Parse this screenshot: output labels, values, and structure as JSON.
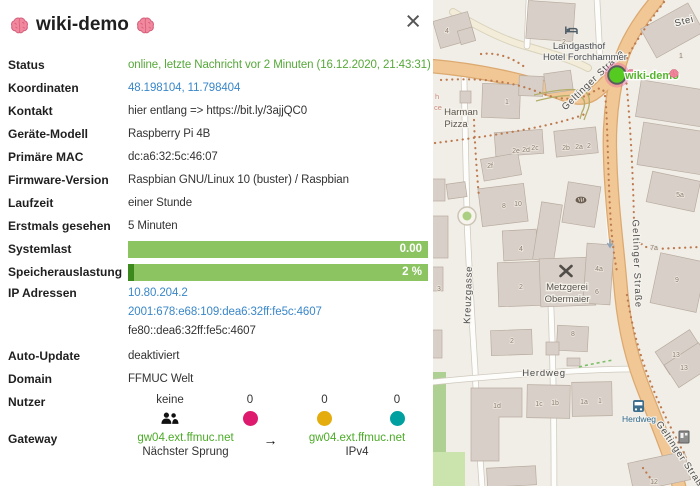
{
  "panel": {
    "title": "wiki-demo",
    "close": "×",
    "rows": {
      "status": {
        "label": "Status",
        "value": "online, letzte Nachricht vor 2 Minuten (16.12.2020, 21:43:31)"
      },
      "koordinaten": {
        "label": "Koordinaten",
        "value": "48.198104, 11.798404"
      },
      "kontakt": {
        "label": "Kontakt",
        "value": "hier entlang => https://bit.ly/3ajjQC0"
      },
      "geraet": {
        "label": "Geräte-Modell",
        "value": "Raspberry Pi 4B"
      },
      "mac": {
        "label": "Primäre MAC",
        "value": "dc:a6:32:5c:46:07"
      },
      "firmware": {
        "label": "Firmware-Version",
        "value": "Raspbian GNU/Linux 10 (buster) / Raspbian"
      },
      "laufzeit": {
        "label": "Laufzeit",
        "value": "einer Stunde"
      },
      "erstmals": {
        "label": "Erstmals gesehen",
        "value": "5 Minuten"
      },
      "systemlast": {
        "label": "Systemlast",
        "value": "0.00",
        "percent": 0
      },
      "speicher": {
        "label": "Speicherauslastung",
        "value": "2 %",
        "percent": 2
      },
      "ip": {
        "label": "IP Adressen",
        "addresses": [
          "10.80.204.2",
          "2001:678:e68:109:dea6:32ff:fe5c:4607",
          "fe80::dea6:32ff:fe5c:4607"
        ]
      },
      "autoupdate": {
        "label": "Auto-Update",
        "value": "deaktiviert"
      },
      "domain": {
        "label": "Domain",
        "value": "FFMUC Welt"
      },
      "nutzer": {
        "label": "Nutzer",
        "clients_total": "keine",
        "counts": [
          "0",
          "0",
          "0"
        ]
      },
      "gateway": {
        "label": "Gateway",
        "next_hop": "gw04.ext.ffmuc.net",
        "arrow": "→",
        "next_hop_caption": "Nächster Sprung",
        "ipv4_gw": "gw04.ext.ffmuc.net",
        "ipv4_caption": "IPv4"
      }
    }
  },
  "map": {
    "node_label": "wiki-demo",
    "streets": {
      "geltinger": "Geltinger Straße",
      "kreuzgasse": "Kreuzgasse",
      "herdweg": "Herdweg",
      "stein": "Stei"
    },
    "pois": {
      "hotel1": "Landgasthof",
      "hotel2": "Hotel Forchhammer",
      "pizza1": "Harman",
      "pizza2": "Pizza",
      "metzgerei1": "Metzgerei",
      "metzgerei2": "Obermaier",
      "bus_stop": "Herdweg"
    },
    "housenumbers": [
      "4",
      "2",
      "1",
      "1",
      "2e",
      "2d",
      "2c",
      "2b",
      "2a",
      "2",
      "2f",
      "8",
      "10",
      "4",
      "2",
      "5a",
      "7a",
      "9",
      "4a",
      "6",
      "3",
      "2",
      "8",
      "13",
      "13",
      "1d",
      "1c",
      "1b",
      "1a",
      "1",
      "12"
    ],
    "fragments": [
      "h",
      "ce"
    ]
  },
  "colors": {
    "online_green": "#56a83a",
    "link_blue": "#3a87c8",
    "gateway_green": "#4cab28",
    "bar_green_light": "#8cc462",
    "bar_green_dark": "#3c8a1e",
    "client_dot_pink": "#dd1a6e",
    "client_dot_yellow": "#e5ac0e",
    "client_dot_teal": "#00a0a0",
    "node_marker_green": "#55cb21",
    "node_halo_pink": "#eb499e",
    "map_bg": "#f1eee8",
    "building_fill": "#d8d0c8",
    "primary_road": "#f0c795"
  }
}
